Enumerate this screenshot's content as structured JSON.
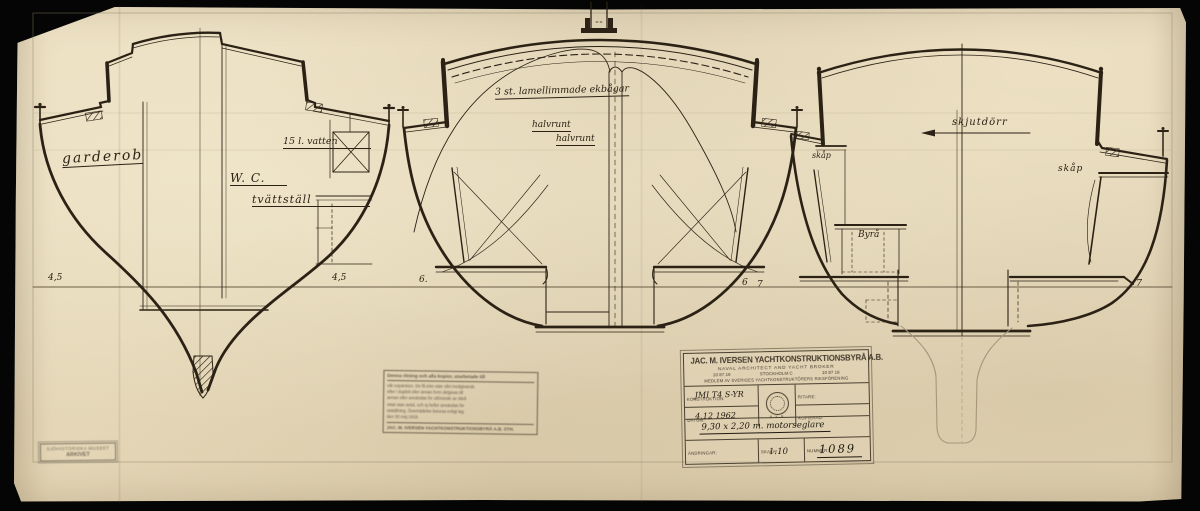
{
  "drawing": {
    "sections": {
      "forward": {
        "labels": {
          "garderob": "garderob",
          "wc": "W. C.",
          "tvattstall": "tvättställ",
          "vatten": "15 l. vatten"
        },
        "waterline_left": "4,5",
        "waterline_right": "4,5"
      },
      "midship": {
        "labels": {
          "ekbagar": "3 st. lamellimmade ekbågar",
          "halvrunt_upper": "halvrunt",
          "halvrunt_lower": "halvrunt"
        },
        "waterline_left": "6.",
        "waterline_right": "6"
      },
      "aft": {
        "labels": {
          "skjutdorr": "skjutdörr",
          "skap_left": "skåp",
          "skap_right": "skåp",
          "byra": "Byrå"
        },
        "waterline_left": "7",
        "waterline_right": "7"
      }
    },
    "ink_color": "#2b2215",
    "paper_color": "#e9dcbf"
  },
  "title_block": {
    "company": "JAC. M. IVERSEN YACHTKONSTRUKTIONSBYRÅ A.B.",
    "subtitle": "NAVAL ARCHITECT AND YACHT BROKER",
    "phone_left": "10 87 19",
    "city": "STOCKHOLM C",
    "phone_right": "10 87 19",
    "membership": "MEDLEM AV SVERIGES YACHTKONSTRUKTÖRERS RIKSFÖRENING",
    "seal_text": "B Y R",
    "fields": {
      "konstruktion_label": "KONSTRUKTION:",
      "konstruktion_value": "JMI T4  S-YR",
      "datum_label": "DATUM:",
      "datum_value": "4.12 1962",
      "ritare_label": "RITARE:",
      "kopierad_label": "KOPIERAD:",
      "beskrivning_value": "9,30 x 2,20 m. motorseglare",
      "andringar_label": "ÄNDRINGAR:",
      "skala_label": "SKALA:",
      "skala_value": "1:10",
      "nummer_label": "NUMMER:",
      "nummer_value": "1089"
    }
  },
  "disclaimer_stamp": {
    "header": "Denna ritning och alla kopior, utarbetade till",
    "body1": "vår expansion. De få icke utan vårt medgivande",
    "body2": "eller i duplett eller annan form delgivas till",
    "body3": "annan eller användas för utförande av därå",
    "body4": "visat utan avtal, och ej heller användas för",
    "body5": "utställning. Överträdelse beivras enligt lag",
    "body6": "den 30 maj 1919.",
    "footer": "JAC. M. IVERSEN YACHTKONSTRUKTIONSBYRÅ A.B. STH."
  },
  "archive_stamp": {
    "line1": "SJÖHISTORISKA MUSEET",
    "line2": "ARKIVET"
  }
}
